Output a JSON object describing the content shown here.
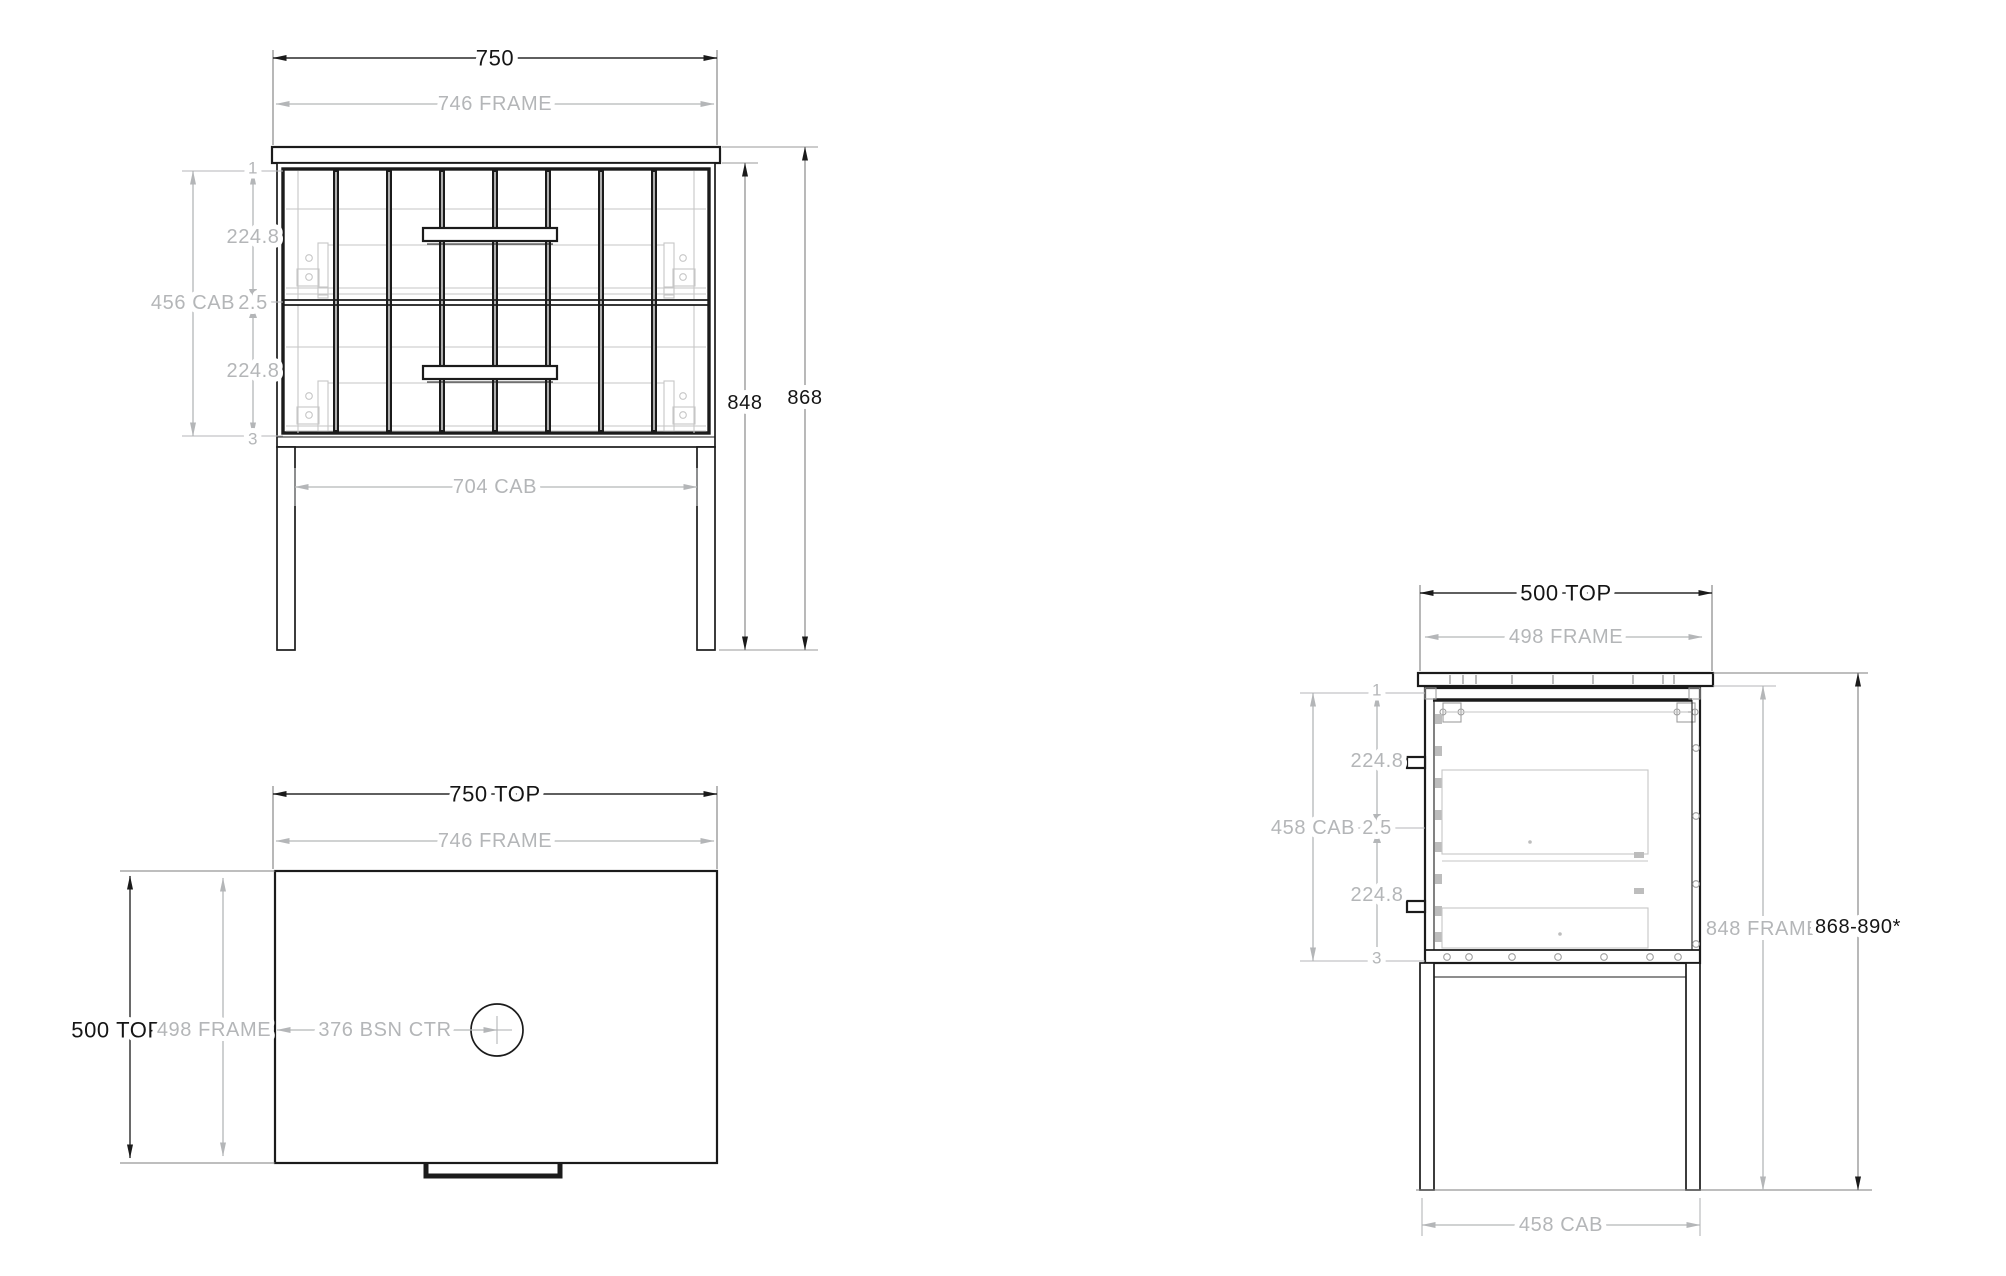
{
  "colors": {
    "line": "#1b1b1b",
    "dim_gray": "#b4b6b8",
    "detail_gray": "#c6c6c6"
  },
  "front": {
    "label_width": "750",
    "label_frame": "746 FRAME",
    "chain": [
      "1",
      "224.8",
      "2.5",
      "224.8",
      "3"
    ],
    "label_cab_height": "456 CAB",
    "label_frame_height": "848",
    "label_overall_height": "868",
    "label_cab_width": "704 CAB"
  },
  "plan": {
    "label_width": "750 TOP",
    "label_frame": "746 FRAME",
    "label_depth": "500 TOP",
    "label_depth_frame": "498 FRAME",
    "label_basin": "376 BSN CTR"
  },
  "side": {
    "label_depth": "500 TOP",
    "label_frame": "498 FRAME",
    "chain": [
      "1",
      "224.8",
      "2.5",
      "224.8",
      "3"
    ],
    "label_cab_height": "458 CAB",
    "label_frame_height": "848 FRAME",
    "label_overall_height": "868-890*",
    "label_cab_depth": "458 CAB"
  }
}
